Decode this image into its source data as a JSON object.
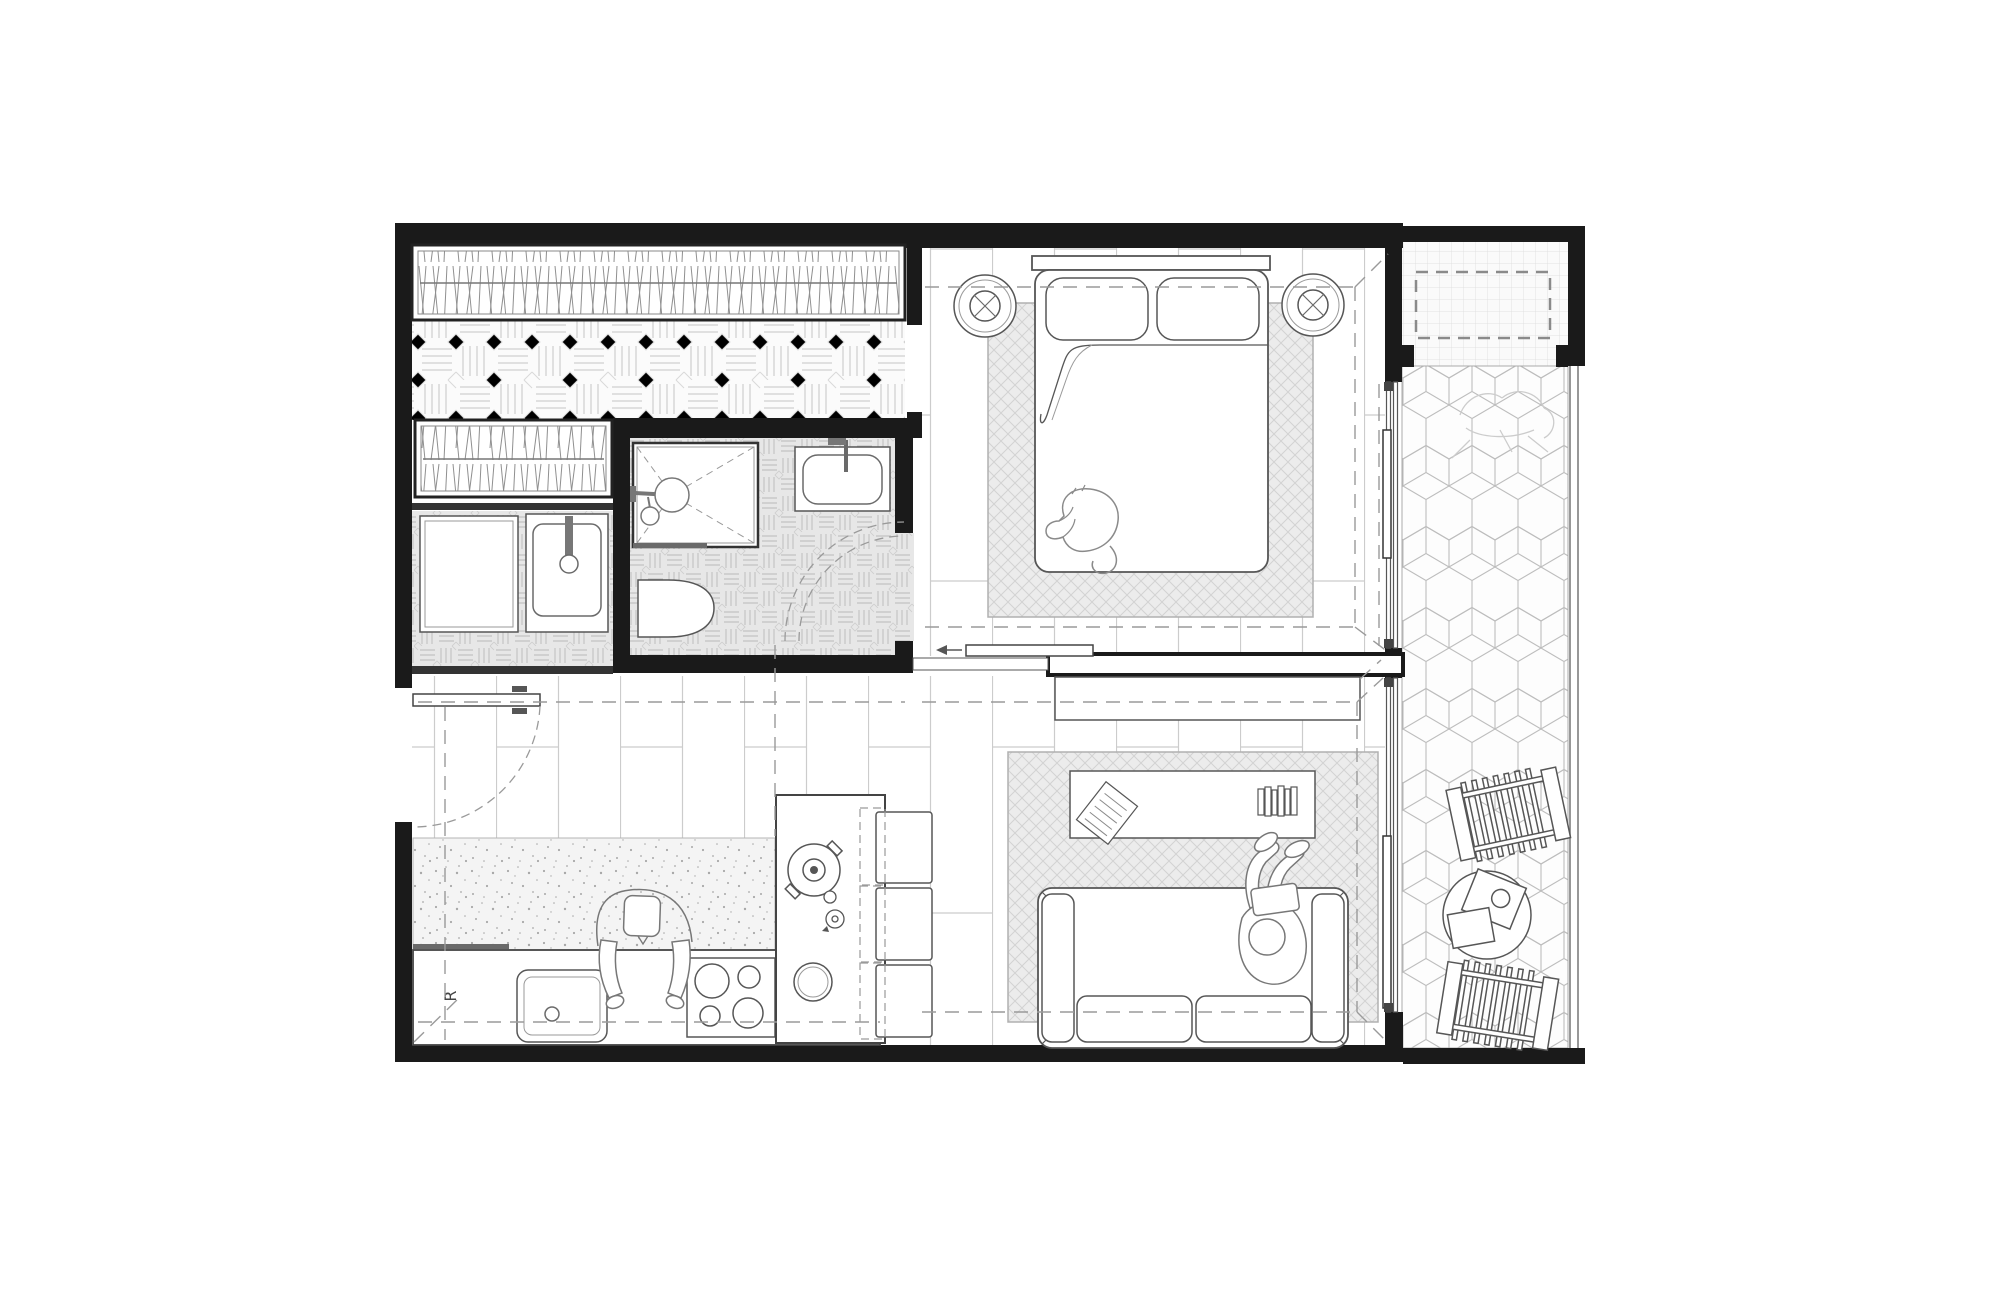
{
  "document": {
    "kind": "architectural floor plan",
    "style": "black and white CAD top view of a one-bedroom apartment with balcony"
  },
  "labels": {
    "refrigerator": "R"
  },
  "palette": {
    "background": "#ffffff",
    "wall": "#1a1a1a",
    "furniture_line": "#565656",
    "light_line": "#9a9a9a",
    "pattern_line": "#c9c9c9",
    "tile_fill": "#e7e7e7",
    "rug_fill": "#ececec",
    "speckle_fill": "#f4f4f4"
  },
  "rooms": [
    {
      "name": "walk-in-closet",
      "features": [
        "wardrobe-hanging-clothes-long",
        "wardrobe-hanging-clothes-short",
        "parquet-basket-floor"
      ]
    },
    {
      "name": "laundry",
      "features": [
        "washing-machine",
        "laundry-sink"
      ]
    },
    {
      "name": "bathroom",
      "features": [
        "walk-in-shower",
        "vanity-sink",
        "toilet",
        "inward-swing-door"
      ]
    },
    {
      "name": "bedroom",
      "features": [
        "double-bed",
        "two-pillows",
        "sleeping-cat",
        "round-side-table-left",
        "round-side-table-right",
        "area-rug",
        "sliding-door-to-living",
        "sliding-glass-door-to-balcony"
      ]
    },
    {
      "name": "kitchen",
      "features": [
        "entry-door",
        "counter-with-sink",
        "cooktop-4-burners",
        "refrigerator-R",
        "island-peninsula",
        "pot",
        "kettle",
        "bowl",
        "three-stools",
        "person-leaning-on-counter",
        "speckled-floor-strip"
      ]
    },
    {
      "name": "living-room",
      "features": [
        "sofa",
        "person-reading-on-sofa",
        "coffee-table",
        "open-book",
        "book-stack",
        "area-rug",
        "sideboard",
        "sliding-glass-door-to-balcony"
      ]
    },
    {
      "name": "balcony",
      "features": [
        "hexagon-tile-floor",
        "planter-dashed",
        "plant-sketch",
        "lounge-chair-top",
        "lounge-chair-bottom",
        "round-table-with-trays",
        "railing"
      ]
    }
  ]
}
